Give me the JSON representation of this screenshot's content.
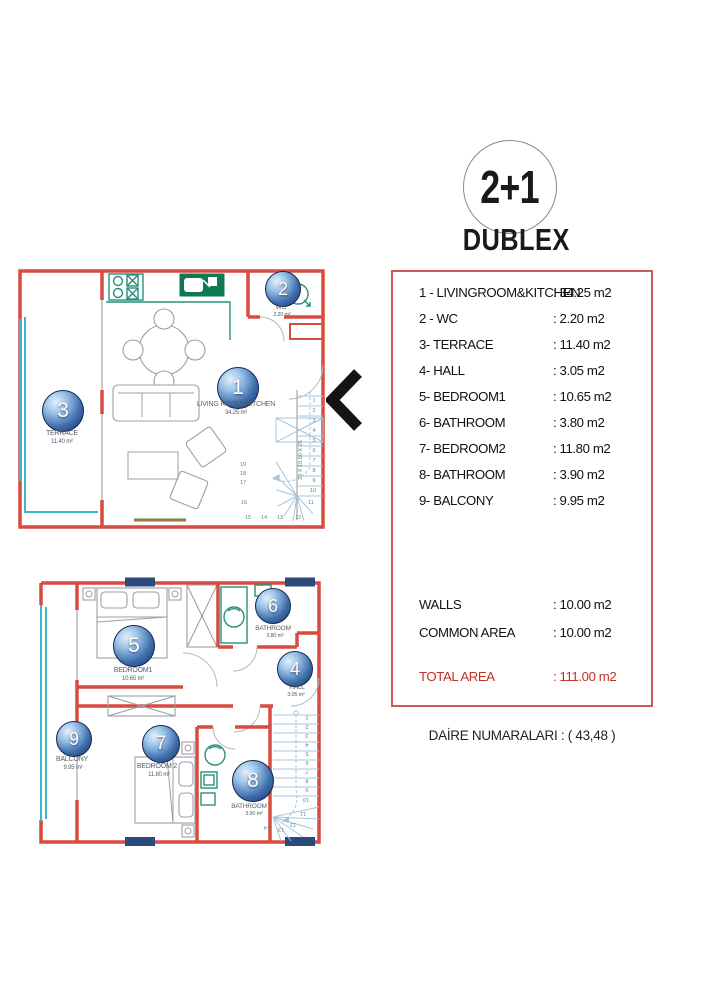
{
  "header": {
    "badge": "2+1",
    "title": "DUBLEX"
  },
  "area_table": {
    "rooms": [
      {
        "label": "1 - LIVINGROOM&KITCHEN",
        "value": ": 34.25 m2"
      },
      {
        "label": "2 - WC",
        "value": ": 2.20 m2"
      },
      {
        "label": "3- TERRACE",
        "value": ": 11.40 m2"
      },
      {
        "label": "4- HALL",
        "value": ": 3.05 m2"
      },
      {
        "label": "5- BEDROOM1",
        "value": ": 10.65 m2"
      },
      {
        "label": "6- BATHROOM",
        "value": ": 3.80 m2"
      },
      {
        "label": "7- BEDROOM2",
        "value": ": 11.80 m2"
      },
      {
        "label": "8- BATHROOM",
        "value": ": 3.90 m2"
      },
      {
        "label": "9- BALCONY",
        "value": ": 9.95 m2"
      }
    ],
    "walls": {
      "label": "WALLS",
      "value": ": 10.00 m2"
    },
    "common": {
      "label": "COMMON AREA",
      "value": ": 10.00 m2"
    },
    "total": {
      "label": "TOTAL AREA",
      "value": ": 111.00 m2"
    }
  },
  "footer": {
    "note": "DAİRE NUMARALARI : ( 43,48 )"
  },
  "upper_floor": {
    "rooms": [
      {
        "num": "1",
        "name": "LIVING ROOM&KITCHEN",
        "area": "34.25 m²"
      },
      {
        "num": "2",
        "name": "WC",
        "area": "2.20 m²"
      },
      {
        "num": "3",
        "name": "TERRACE",
        "area": "11.40 m²"
      }
    ],
    "stair_note": "20 X 18.50 X 25",
    "stair_steps": [
      "1",
      "2",
      "3",
      "4",
      "5",
      "6",
      "7",
      "8",
      "9",
      "10",
      "11",
      "12",
      "13",
      "14",
      "15",
      "16",
      "17",
      "18",
      "19"
    ]
  },
  "lower_floor": {
    "rooms": [
      {
        "num": "4",
        "name": "HALL",
        "area": "3.05 m²"
      },
      {
        "num": "5",
        "name": "BEDROOM1",
        "area": "10.65 m²"
      },
      {
        "num": "6",
        "name": "BATHROOM",
        "area": "3.80 m²"
      },
      {
        "num": "7",
        "name": "BEDROOM 2",
        "area": "11.80 m²"
      },
      {
        "num": "8",
        "name": "BATHROOM",
        "area": "3.90 m²"
      },
      {
        "num": "9",
        "name": "BALCONY",
        "area": "9.95 m²"
      }
    ],
    "stair_steps": [
      "1",
      "2",
      "3",
      "4",
      "5",
      "6",
      "7",
      "8",
      "9",
      "10",
      "11",
      "12",
      "13",
      "14"
    ]
  },
  "icons": {
    "floor_link": "chevron-left-icon"
  },
  "colors": {
    "wall_red": "#d94a41",
    "box_border_red": "#cb5a55",
    "total_red": "#c2302a",
    "cyan": "#3db7cc",
    "stair_blue": "#a5c5de",
    "fixture_teal": "#27907c",
    "fixture_dark_green": "#0e7a52",
    "column_navy": "#2a4a7c"
  }
}
